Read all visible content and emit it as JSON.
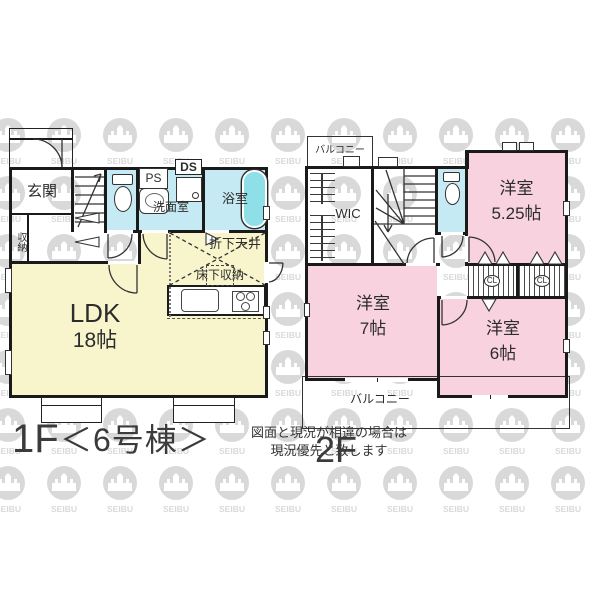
{
  "watermark": {
    "text": "SEIBU"
  },
  "colors": {
    "wall": "#1a1a1a",
    "room_yellow": "#F8F5CD",
    "room_pink": "#F8D3DF",
    "room_blue": "#C5EAF3",
    "tub_blue": "#8FDFE9",
    "watermark_gray": "#d9d9d9"
  },
  "floor1": {
    "caption": "1F",
    "unit": "＜6号棟＞",
    "note_line1": "図面と現況が相違の場合は",
    "note_line2": "現況優先と致します",
    "rooms": {
      "genkan": "玄関",
      "storage": "収納",
      "ps": "PS",
      "ds": "DS",
      "washroom": "洗面室",
      "bathroom": "浴室",
      "dropped_ceiling": "折下天井",
      "floor_storage": "床下収納",
      "ldk_name": "LDK",
      "ldk_size": "18帖"
    }
  },
  "floor2": {
    "caption": "2F",
    "rooms": {
      "balcony_top": "バルコニー",
      "wic": "WIC",
      "room525_name": "洋室",
      "room525_size": "5.25帖",
      "closet": "CL",
      "room7_name": "洋室",
      "room7_size": "7帖",
      "room6_name": "洋室",
      "room6_size": "6帖",
      "balcony_bottom": "バルコニー"
    }
  }
}
